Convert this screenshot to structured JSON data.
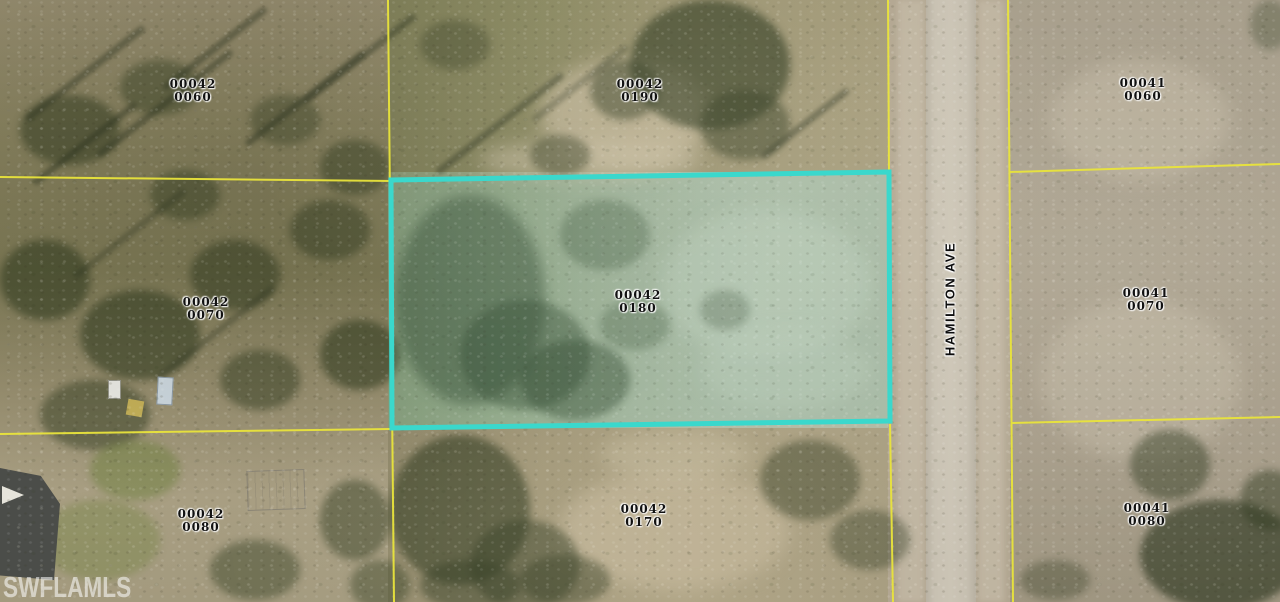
{
  "map": {
    "street_label": "HAMILTON AVE",
    "watermark": "SWFLAMLS",
    "parcels": [
      {
        "id_line1": "00042",
        "id_line2": "0060",
        "position": "top-left",
        "highlighted": false
      },
      {
        "id_line1": "00042",
        "id_line2": "0190",
        "position": "top-center",
        "highlighted": false
      },
      {
        "id_line1": "00041",
        "id_line2": "0060",
        "position": "top-right",
        "highlighted": false
      },
      {
        "id_line1": "00042",
        "id_line2": "0070",
        "position": "middle-left",
        "highlighted": false
      },
      {
        "id_line1": "00042",
        "id_line2": "0180",
        "position": "middle-center",
        "highlighted": true
      },
      {
        "id_line1": "00041",
        "id_line2": "0070",
        "position": "middle-right",
        "highlighted": false
      },
      {
        "id_line1": "00042",
        "id_line2": "0080",
        "position": "bottom-left",
        "highlighted": false
      },
      {
        "id_line1": "00042",
        "id_line2": "0170",
        "position": "bottom-center",
        "highlighted": false
      },
      {
        "id_line1": "00041",
        "id_line2": "0080",
        "position": "bottom-right",
        "highlighted": false
      }
    ],
    "colors": {
      "parcel_boundary": "#e9e43b",
      "highlight_boundary": "#3ad8cc",
      "label_text": "#111111",
      "watermark_text": "#ffffff"
    }
  }
}
